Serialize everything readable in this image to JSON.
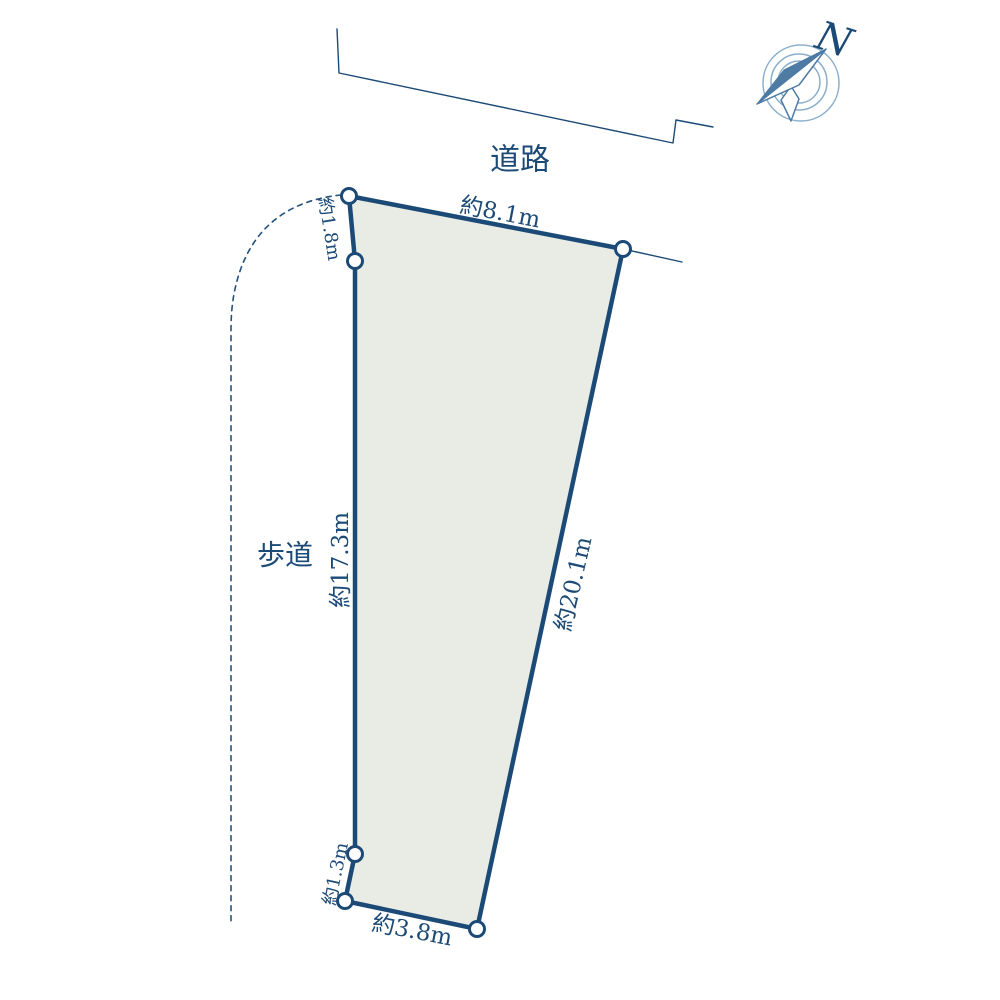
{
  "labels": {
    "road": "道路",
    "sidewalk": "歩道"
  },
  "compass": {
    "north_label": "N"
  },
  "plot": {
    "dimensions": {
      "top": "約8.1m",
      "upper_left": "約1.8m",
      "left": "約17.3m",
      "right": "約20.1m",
      "lower_left": "約1.3m",
      "bottom": "約3.8m"
    }
  },
  "colors": {
    "outline": "#1c4a76",
    "plot_fill": "#e8ece5",
    "dashed_line": "#24517b",
    "compass_ring": "#8bafcb",
    "compass_needle": "#4d7ba4",
    "background": "#ffffff"
  }
}
